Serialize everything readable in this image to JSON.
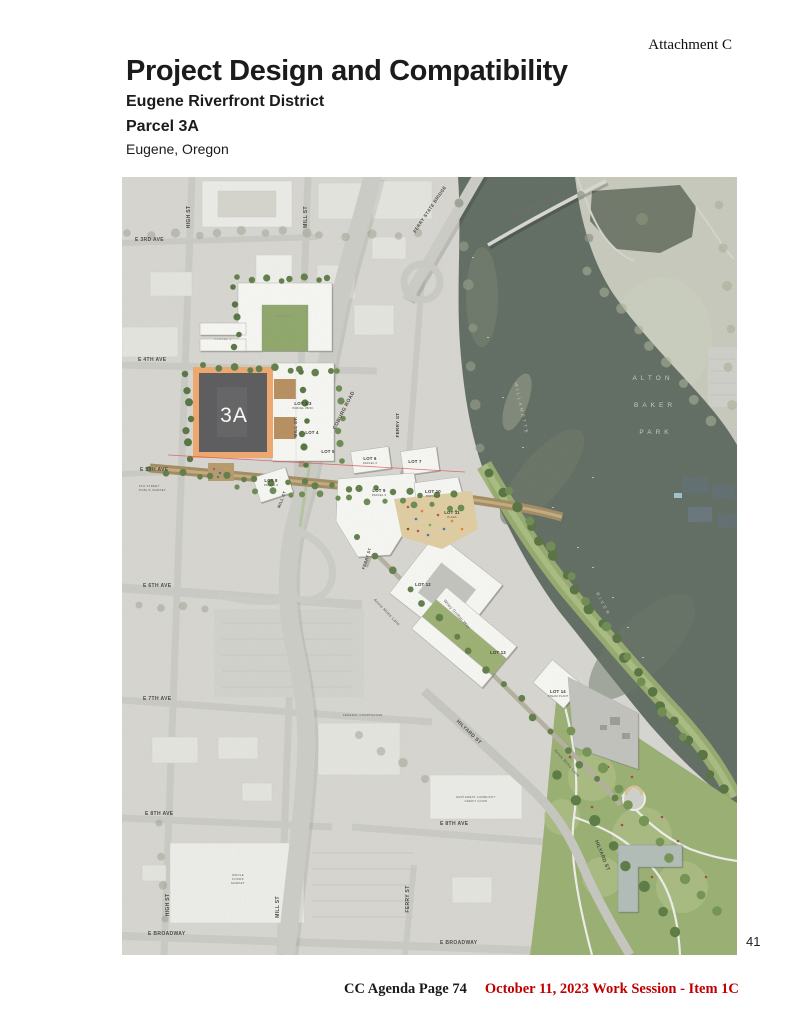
{
  "page": {
    "attachment_label": "Attachment C",
    "page_number": "41",
    "footer_left": "CC Agenda Page 74",
    "footer_right": "October 11, 2023 Work Session - Item 1C"
  },
  "header": {
    "title": "Project Design and Compatibility",
    "district": "Eugene Riverfront District",
    "parcel": "Parcel 3A",
    "city": "Eugene, Oregon"
  },
  "map": {
    "parcel_3a": {
      "label": "3A",
      "outline_color": "#f3a96c",
      "fill_color": "#59595b"
    },
    "colors": {
      "river": "#5f6b61",
      "park_wash": "#c9ccbe",
      "site_green": "#9ab171",
      "plaza_tan": "#e3cfa2",
      "street_brown": "#a58b60",
      "wash_base": "#dad9d4",
      "section_line_red": "#e05050",
      "footer_red": "#c00000"
    },
    "labels": [
      {
        "t": "E 3RD AVE",
        "x": 13,
        "y": 64,
        "a": "start"
      },
      {
        "t": "HIGH ST",
        "x": 68,
        "y": 40,
        "r": -90
      },
      {
        "t": "MILL ST",
        "x": 185,
        "y": 40,
        "r": -90
      },
      {
        "t": "FERRY STATE BRIDGE",
        "x": 309,
        "y": 33,
        "r": -56,
        "s": 4.5
      },
      {
        "t": "PETER DEFAZIO BRIDGE",
        "x": 413,
        "y": 30,
        "r": -25,
        "s": 4,
        "c": "#6b6b64"
      },
      {
        "t": "E 4TH AVE",
        "x": 16,
        "y": 184,
        "a": "start"
      },
      {
        "t": "COBURG ROAD",
        "x": 223,
        "y": 234,
        "r": -63
      },
      {
        "t": "MILL ST.",
        "x": 175,
        "y": 250,
        "r": -90,
        "s": 4.5
      },
      {
        "t": "FERRY ST",
        "x": 277,
        "y": 248,
        "r": -90,
        "s": 4.5
      },
      {
        "t": "E 5TH AVE",
        "x": 18,
        "y": 294,
        "a": "start"
      },
      {
        "t": "MILL ST",
        "x": 161,
        "y": 323,
        "r": -70,
        "s": 4
      },
      {
        "t": "FERRY ST",
        "x": 246,
        "y": 382,
        "r": -72,
        "s": 4
      },
      {
        "t": "E 6TH AVE",
        "x": 21,
        "y": 410,
        "a": "start"
      },
      {
        "t": "E 7TH AVE",
        "x": 21,
        "y": 523,
        "a": "start"
      },
      {
        "t": "E 8TH AVE",
        "x": 23,
        "y": 638,
        "a": "start"
      },
      {
        "t": "E 8TH AVE",
        "x": 318,
        "y": 648,
        "a": "start"
      },
      {
        "t": "HIGH ST",
        "x": 47,
        "y": 728,
        "r": -90
      },
      {
        "t": "MILL ST",
        "x": 157,
        "y": 730,
        "r": -90
      },
      {
        "t": "FERRY ST",
        "x": 287,
        "y": 722,
        "r": -90
      },
      {
        "t": "E BROADWAY",
        "x": 26,
        "y": 758,
        "a": "start"
      },
      {
        "t": "E BROADWAY",
        "x": 318,
        "y": 767,
        "a": "start"
      },
      {
        "t": "HILYARD ST",
        "x": 346,
        "y": 556,
        "r": 44
      },
      {
        "t": "HILYARD ST",
        "x": 479,
        "y": 679,
        "r": 68
      },
      {
        "t": "Annie Mims Lane",
        "x": 264,
        "y": 436,
        "r": 46,
        "s": 4,
        "w": 400,
        "c": "#55554e"
      },
      {
        "t": "Annie Mims Lane",
        "x": 444,
        "y": 587,
        "r": 48,
        "s": 4,
        "w": 400,
        "c": "#55554e"
      },
      {
        "t": "Wiley Griffon Way",
        "x": 334,
        "y": 438,
        "r": 48,
        "s": 4,
        "w": 400,
        "c": "#55554e"
      },
      {
        "t": "ALTON",
        "x": 531,
        "y": 203,
        "s": 6.5,
        "ls": 4,
        "c": "#c8ccbf",
        "w": 400
      },
      {
        "t": "BAKER",
        "x": 533,
        "y": 230,
        "s": 6.5,
        "ls": 4,
        "c": "#c8ccbf",
        "w": 400
      },
      {
        "t": "PARK",
        "x": 534,
        "y": 257,
        "s": 6.5,
        "ls": 4,
        "c": "#c8ccbf",
        "w": 400
      },
      {
        "t": "WILLAMETTE",
        "x": 398,
        "y": 232,
        "r": 78,
        "s": 4.5,
        "ls": 2.5,
        "c": "#c3c9bd",
        "w": 400
      },
      {
        "t": "RIVER",
        "x": 480,
        "y": 428,
        "r": 62,
        "s": 4.5,
        "ls": 2.5,
        "c": "#c3c9bd",
        "w": 400
      },
      {
        "t": "5TH STREET",
        "x": 17,
        "y": 310,
        "s": 2.8,
        "a": "start",
        "w": 400,
        "c": "#55544e"
      },
      {
        "t": "PUBLIC MARKET",
        "x": 17,
        "y": 314,
        "s": 2.8,
        "a": "start",
        "w": 400,
        "c": "#55544e"
      },
      {
        "t": "FEDERAL COURTHOUSE",
        "x": 221,
        "y": 539,
        "s": 2.8,
        "a": "start",
        "w": 400,
        "c": "#55544e"
      },
      {
        "t": "NORTHWEST COMMUNITY",
        "x": 354,
        "y": 621,
        "s": 2.6,
        "w": 400,
        "c": "#55544e"
      },
      {
        "t": "CREDIT UNION",
        "x": 354,
        "y": 625,
        "s": 2.6,
        "w": 400,
        "c": "#55544e"
      },
      {
        "t": "WHOLE",
        "x": 116,
        "y": 699,
        "s": 2.8,
        "w": 400,
        "c": "#55544e"
      },
      {
        "t": "FOODS",
        "x": 116,
        "y": 703,
        "s": 2.8,
        "w": 400,
        "c": "#55544e"
      },
      {
        "t": "MARKET",
        "x": 116,
        "y": 707,
        "s": 2.8,
        "w": 400,
        "c": "#55544e"
      },
      {
        "t": "PARCEL 2",
        "x": 163,
        "y": 140,
        "s": 3,
        "w": 400,
        "c": "#8a8a82"
      },
      {
        "t": "PARCEL 1",
        "x": 101,
        "y": 163,
        "s": 3,
        "w": 400,
        "c": "#8a8a82"
      },
      {
        "t": "3A",
        "x": 112,
        "y": 245,
        "s": 21,
        "w": 400,
        "c": "#ffffff",
        "ls": 1
      }
    ],
    "lot_labels": [
      {
        "t": "LOT 2/3",
        "sub": "PARCEL 3B/3C",
        "x": 181,
        "y": 228
      },
      {
        "t": "LOT 4",
        "x": 190,
        "y": 257
      },
      {
        "t": "LOT 5",
        "x": 206,
        "y": 276
      },
      {
        "t": "LOT 6",
        "sub": "PARCEL 6",
        "x": 248,
        "y": 283
      },
      {
        "t": "LOT 7",
        "x": 293,
        "y": 286
      },
      {
        "t": "LOT 8",
        "sub": "PARCEL 8",
        "x": 149,
        "y": 305
      },
      {
        "t": "LOT 9",
        "sub": "PARCEL 9",
        "x": 257,
        "y": 315
      },
      {
        "t": "LOT 10",
        "sub": "PARCEL B",
        "x": 311,
        "y": 316
      },
      {
        "t": "LOT 11",
        "sub": "PLAZA",
        "x": 330,
        "y": 337
      },
      {
        "t": "LOT 12",
        "x": 301,
        "y": 409
      },
      {
        "t": "LOT 13",
        "x": 376,
        "y": 477
      },
      {
        "t": "LOT 14",
        "sub": "STEAM PLANT",
        "x": 436,
        "y": 516
      }
    ]
  }
}
